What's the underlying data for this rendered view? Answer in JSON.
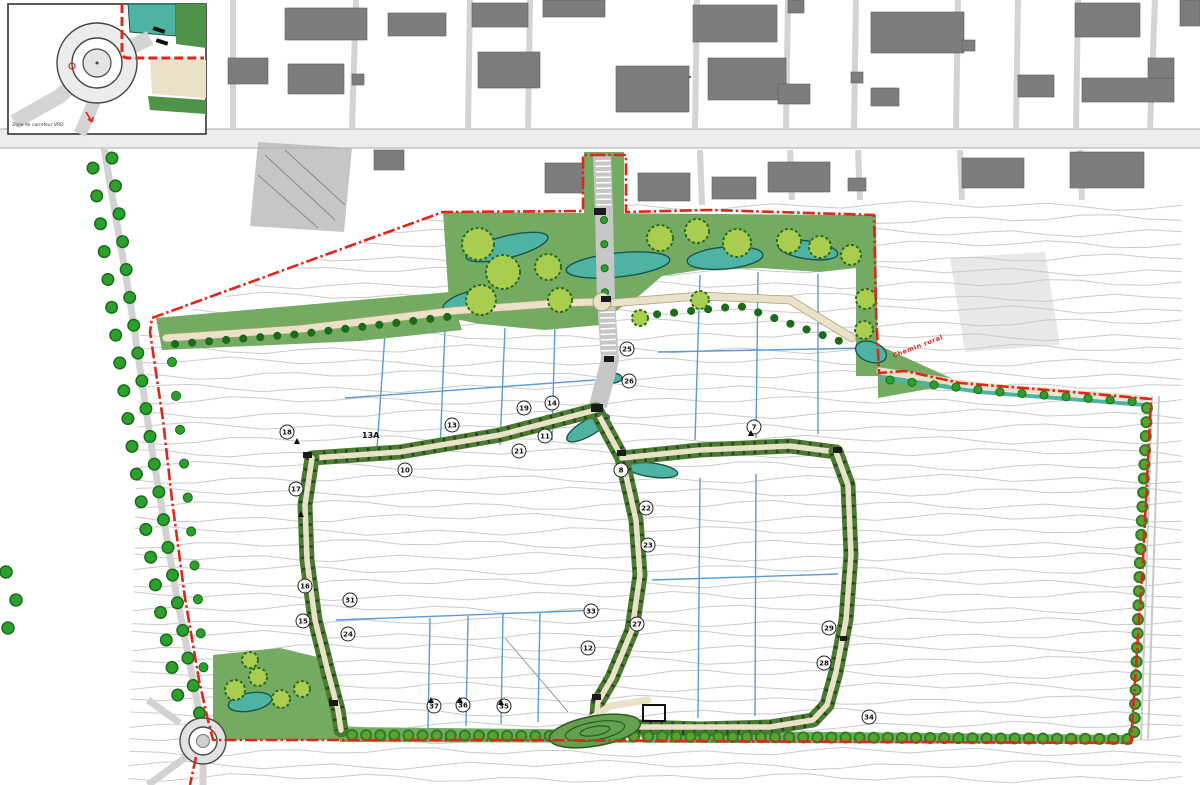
{
  "map": {
    "kind": "urban-development-site-plan",
    "inset": {
      "caption": "Zone de carrefour VRD"
    },
    "annotations": {
      "red_label": "Chemin rural",
      "lot_label": "13A"
    },
    "markers": [
      {
        "x": 627,
        "y": 349,
        "n": "25"
      },
      {
        "x": 629,
        "y": 381,
        "n": "26"
      },
      {
        "x": 524,
        "y": 408,
        "n": "19"
      },
      {
        "x": 552,
        "y": 403,
        "n": "14"
      },
      {
        "x": 545,
        "y": 436,
        "n": "11"
      },
      {
        "x": 519,
        "y": 451,
        "n": "21"
      },
      {
        "x": 452,
        "y": 425,
        "n": "13"
      },
      {
        "x": 405,
        "y": 470,
        "n": "10"
      },
      {
        "x": 287,
        "y": 432,
        "n": "18"
      },
      {
        "x": 296,
        "y": 489,
        "n": "17"
      },
      {
        "x": 305,
        "y": 586,
        "n": "16"
      },
      {
        "x": 303,
        "y": 621,
        "n": "15"
      },
      {
        "x": 350,
        "y": 600,
        "n": "31"
      },
      {
        "x": 348,
        "y": 634,
        "n": "24"
      },
      {
        "x": 754,
        "y": 427,
        "n": "7"
      },
      {
        "x": 621,
        "y": 470,
        "n": "8"
      },
      {
        "x": 646,
        "y": 508,
        "n": "22"
      },
      {
        "x": 648,
        "y": 545,
        "n": "23"
      },
      {
        "x": 591,
        "y": 611,
        "n": "33"
      },
      {
        "x": 637,
        "y": 624,
        "n": "27"
      },
      {
        "x": 588,
        "y": 648,
        "n": "12"
      },
      {
        "x": 829,
        "y": 628,
        "n": "29"
      },
      {
        "x": 824,
        "y": 663,
        "n": "28"
      },
      {
        "x": 869,
        "y": 717,
        "n": "34"
      },
      {
        "x": 434,
        "y": 706,
        "n": "37"
      },
      {
        "x": 463,
        "y": 705,
        "n": "36"
      },
      {
        "x": 504,
        "y": 706,
        "n": "35"
      }
    ],
    "triangles": [
      {
        "x": 297,
        "y": 441
      },
      {
        "x": 301,
        "y": 514
      },
      {
        "x": 431,
        "y": 700
      },
      {
        "x": 460,
        "y": 700
      },
      {
        "x": 501,
        "y": 702
      },
      {
        "x": 751,
        "y": 433
      }
    ],
    "colors": {
      "boundary": "#e0251b",
      "park": "#74ab63",
      "pond": "#4fb3a4",
      "pond_line": "#17564a",
      "tree": "#2ca02c",
      "tree_dark": "#1b6b1b",
      "canopy": "#a9cd4f",
      "canopy_line": "#2f6b1f",
      "path": "#e9e2c8",
      "path_line": "#a89f6f",
      "building": "#7d7d7d",
      "contour": "#c8c8c8",
      "parcel_blue": "#5b9bd5"
    }
  }
}
